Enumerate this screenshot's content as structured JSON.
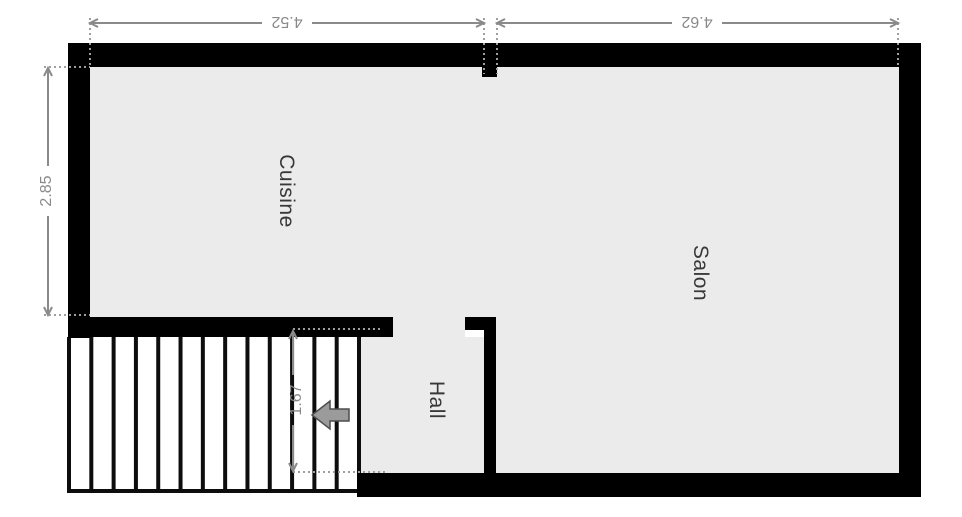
{
  "plan_title": "floor-plan",
  "colors": {
    "background": "#ffffff",
    "floor": "#ebebeb",
    "wall": "#000000",
    "dimension": "#8a8a8a",
    "dotted": "#9e9e9e",
    "room_label": "#383838",
    "stair_line": "#0d0d0d",
    "arrow_fill": "#9b9b9b",
    "arrow_stroke": "#4d4d4d"
  },
  "rooms": [
    {
      "id": "cuisine",
      "label": "Cuisine"
    },
    {
      "id": "salon",
      "label": "Salon"
    },
    {
      "id": "hall",
      "label": "Hall"
    }
  ],
  "dimensions": [
    {
      "id": "top-left-width",
      "value": "4.52"
    },
    {
      "id": "top-right-width",
      "value": "4.62"
    },
    {
      "id": "left-height",
      "value": "2.85"
    },
    {
      "id": "stair-depth",
      "value": "1.67"
    }
  ],
  "stairs": {
    "tread_count": 13
  },
  "entry_arrow": {
    "direction": "left"
  }
}
